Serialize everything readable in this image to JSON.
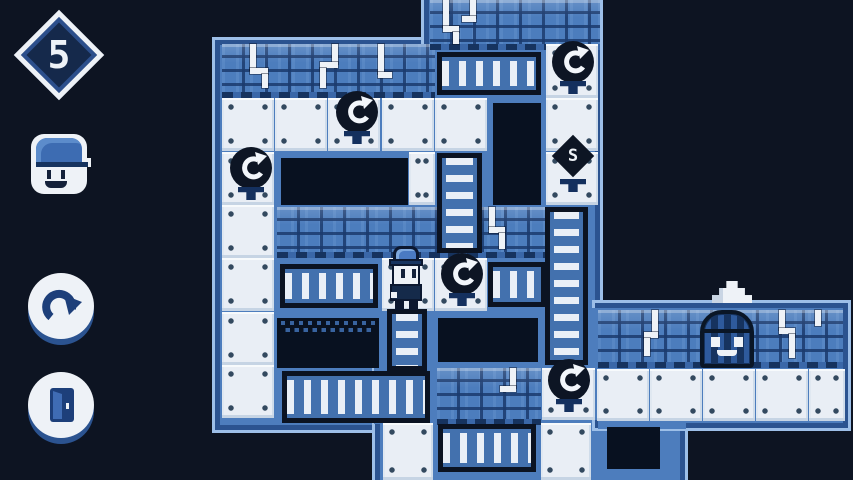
{
  "hud": {
    "level": "5",
    "portrait_icon": "player-face-icon",
    "buttons": [
      {
        "name": "undo-button",
        "icon": "redo-arrow-icon"
      },
      {
        "name": "exit-level-button",
        "icon": "door-icon"
      }
    ]
  },
  "colors": {
    "background": "#0d1422",
    "map_base": "#4d7dbd",
    "map_border": "#2b5390",
    "map_outline": "#9dbfe8",
    "wall": "#4c7dbd",
    "tile": "#e9eef5",
    "pit": "#081120",
    "ladder_frame": "#0b1322",
    "ladder_fill": "#4371ae",
    "object_dark": "#0d1524",
    "white": "#eef2f7"
  },
  "map": {
    "sections": [
      [
        215,
        40,
        220,
        390
      ],
      [
        424,
        -12,
        176,
        377
      ],
      [
        375,
        355,
        310,
        135
      ],
      [
        595,
        303,
        253,
        125
      ]
    ],
    "patches": [
      [
        420,
        44,
        22,
        374
      ],
      [
        378,
        352,
        220,
        12
      ],
      [
        374,
        352,
        12,
        72
      ],
      [
        589,
        308,
        13,
        112
      ],
      [
        598,
        353,
        88,
        76
      ]
    ],
    "walls": [
      [
        222,
        44,
        213,
        54
      ],
      [
        430,
        0,
        170,
        50
      ],
      [
        277,
        207,
        269,
        51
      ],
      [
        437,
        368,
        104,
        57
      ],
      [
        598,
        310,
        245,
        58
      ]
    ],
    "pipes": [
      [
        [
          250,
          44,
          6,
          26
        ],
        [
          250,
          68,
          18,
          6
        ],
        [
          262,
          74,
          6,
          14
        ]
      ],
      [
        [
          332,
          44,
          6,
          20
        ],
        [
          320,
          62,
          18,
          6
        ],
        [
          320,
          68,
          6,
          20
        ]
      ],
      [
        [
          378,
          44,
          6,
          30
        ],
        [
          378,
          72,
          14,
          6
        ]
      ],
      [
        [
          443,
          0,
          6,
          28
        ],
        [
          443,
          26,
          16,
          6
        ],
        [
          453,
          32,
          6,
          12
        ]
      ],
      [
        [
          470,
          0,
          6,
          18
        ],
        [
          462,
          16,
          14,
          6
        ]
      ],
      [
        [
          489,
          207,
          6,
          22
        ],
        [
          489,
          227,
          16,
          6
        ],
        [
          499,
          233,
          6,
          16
        ]
      ],
      [
        [
          510,
          368,
          6,
          20
        ],
        [
          500,
          386,
          16,
          6
        ]
      ],
      [
        [
          652,
          310,
          6,
          24
        ],
        [
          644,
          332,
          14,
          6
        ],
        [
          644,
          338,
          6,
          18
        ]
      ],
      [
        [
          779,
          310,
          6,
          20
        ],
        [
          779,
          328,
          16,
          6
        ],
        [
          789,
          334,
          6,
          24
        ]
      ],
      [
        [
          815,
          310,
          6,
          16
        ]
      ]
    ],
    "pits": [
      [
        281,
        158,
        127,
        47
      ],
      [
        493,
        103,
        48,
        102
      ],
      [
        277,
        318,
        102,
        50,
        "dotted"
      ],
      [
        438,
        318,
        100,
        44
      ],
      [
        607,
        427,
        53,
        42
      ]
    ],
    "tiles": [
      [
        222,
        98
      ],
      [
        275,
        98
      ],
      [
        328,
        98
      ],
      [
        382,
        98
      ],
      [
        222,
        152
      ],
      [
        409,
        152,
        26,
        53
      ],
      [
        222,
        205
      ],
      [
        222,
        258
      ],
      [
        382,
        258
      ],
      [
        222,
        312
      ],
      [
        222,
        365
      ],
      [
        546,
        44,
        52,
        54
      ],
      [
        435,
        98
      ],
      [
        546,
        98
      ],
      [
        546,
        152
      ],
      [
        435,
        258
      ],
      [
        542,
        368,
        53,
        52
      ],
      [
        597,
        369,
        52,
        52
      ],
      [
        650,
        369,
        52,
        52
      ],
      [
        703,
        369,
        52,
        52
      ],
      [
        756,
        369,
        52,
        52
      ],
      [
        809,
        369,
        36,
        52
      ],
      [
        383,
        423,
        50,
        57
      ],
      [
        541,
        423,
        50,
        57
      ]
    ],
    "ladders": [
      [
        "h",
        437,
        52,
        104,
        43
      ],
      [
        "v",
        437,
        153,
        45,
        100
      ],
      [
        "h",
        488,
        262,
        58,
        45
      ],
      [
        "v",
        545,
        207,
        43,
        158
      ],
      [
        "h",
        280,
        264,
        98,
        44
      ],
      [
        "v",
        387,
        309,
        40,
        62
      ],
      [
        "h",
        282,
        371,
        148,
        52
      ],
      [
        "h",
        438,
        424,
        98,
        48
      ]
    ],
    "switches": {
      "glyph": "rotate-arrow",
      "positions": [
        [
          357,
          112
        ],
        [
          251,
          168
        ],
        [
          573,
          62
        ],
        [
          462,
          274
        ],
        [
          569,
          380
        ]
      ]
    },
    "diamond": {
      "x": 573,
      "y": 156,
      "label": "S"
    },
    "player": {
      "x": 386,
      "y": 246
    },
    "door": {
      "x": 700,
      "y": 310
    },
    "triangle": {
      "x": 712,
      "y": 281
    }
  }
}
